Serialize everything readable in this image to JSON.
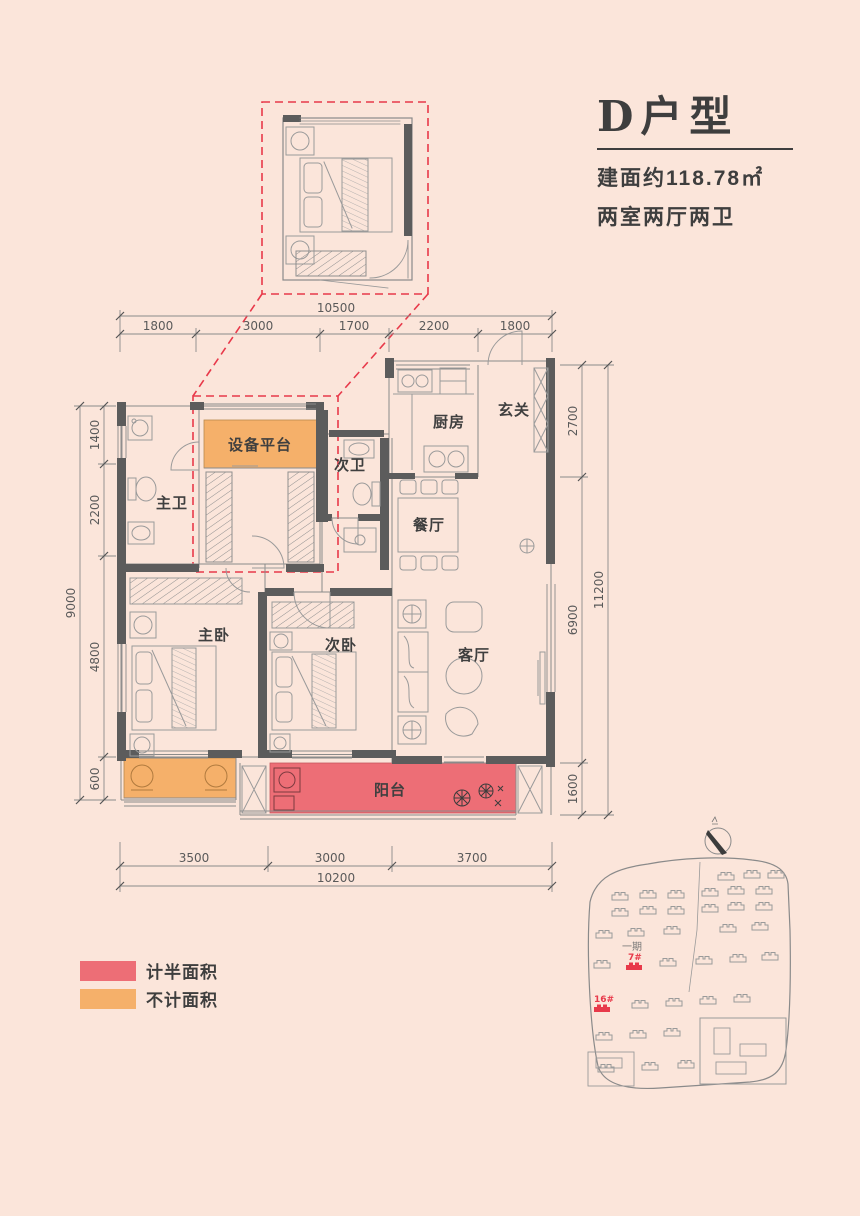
{
  "unit": {
    "title": "D户型",
    "area": "建面约118.78㎡",
    "rooms_summary": "两室两厅两卫"
  },
  "rooms": {
    "equipment_platform": "设备平台",
    "second_bathroom": "次卫",
    "master_bathroom": "主卫",
    "kitchen": "厨房",
    "foyer": "玄关",
    "dining_room": "餐厅",
    "master_bedroom": "主卧",
    "second_bedroom": "次卧",
    "living_room": "客厅",
    "balcony": "阳台"
  },
  "dimensions": {
    "top": {
      "total": "10500",
      "segments": [
        "1800",
        "3000",
        "1700",
        "2200",
        "1800"
      ]
    },
    "bottom": {
      "total": "10200",
      "segments": [
        "3500",
        "3000",
        "3700"
      ]
    },
    "left": {
      "total": "9000",
      "segments": [
        "1400",
        "2200",
        "4800",
        "600"
      ]
    },
    "right": {
      "total": "11200",
      "segments": [
        "2700",
        "6900",
        "1600"
      ]
    }
  },
  "legend": {
    "half_area": {
      "label": "计半面积",
      "color": "#ed6e76"
    },
    "excluded_area": {
      "label": "不计面积",
      "color": "#f5b06a"
    }
  },
  "site_plan": {
    "phase_label": "一期",
    "building_7": "7#",
    "building_16": "16#"
  },
  "colors": {
    "background": "#fbe5da",
    "wall": "#5c5c5c",
    "line": "#8a8a8a",
    "highlight_red": "#e8394a",
    "balcony_fill": "#ed6e76",
    "platform_fill": "#f5b06a",
    "text": "#3e3e3e"
  }
}
